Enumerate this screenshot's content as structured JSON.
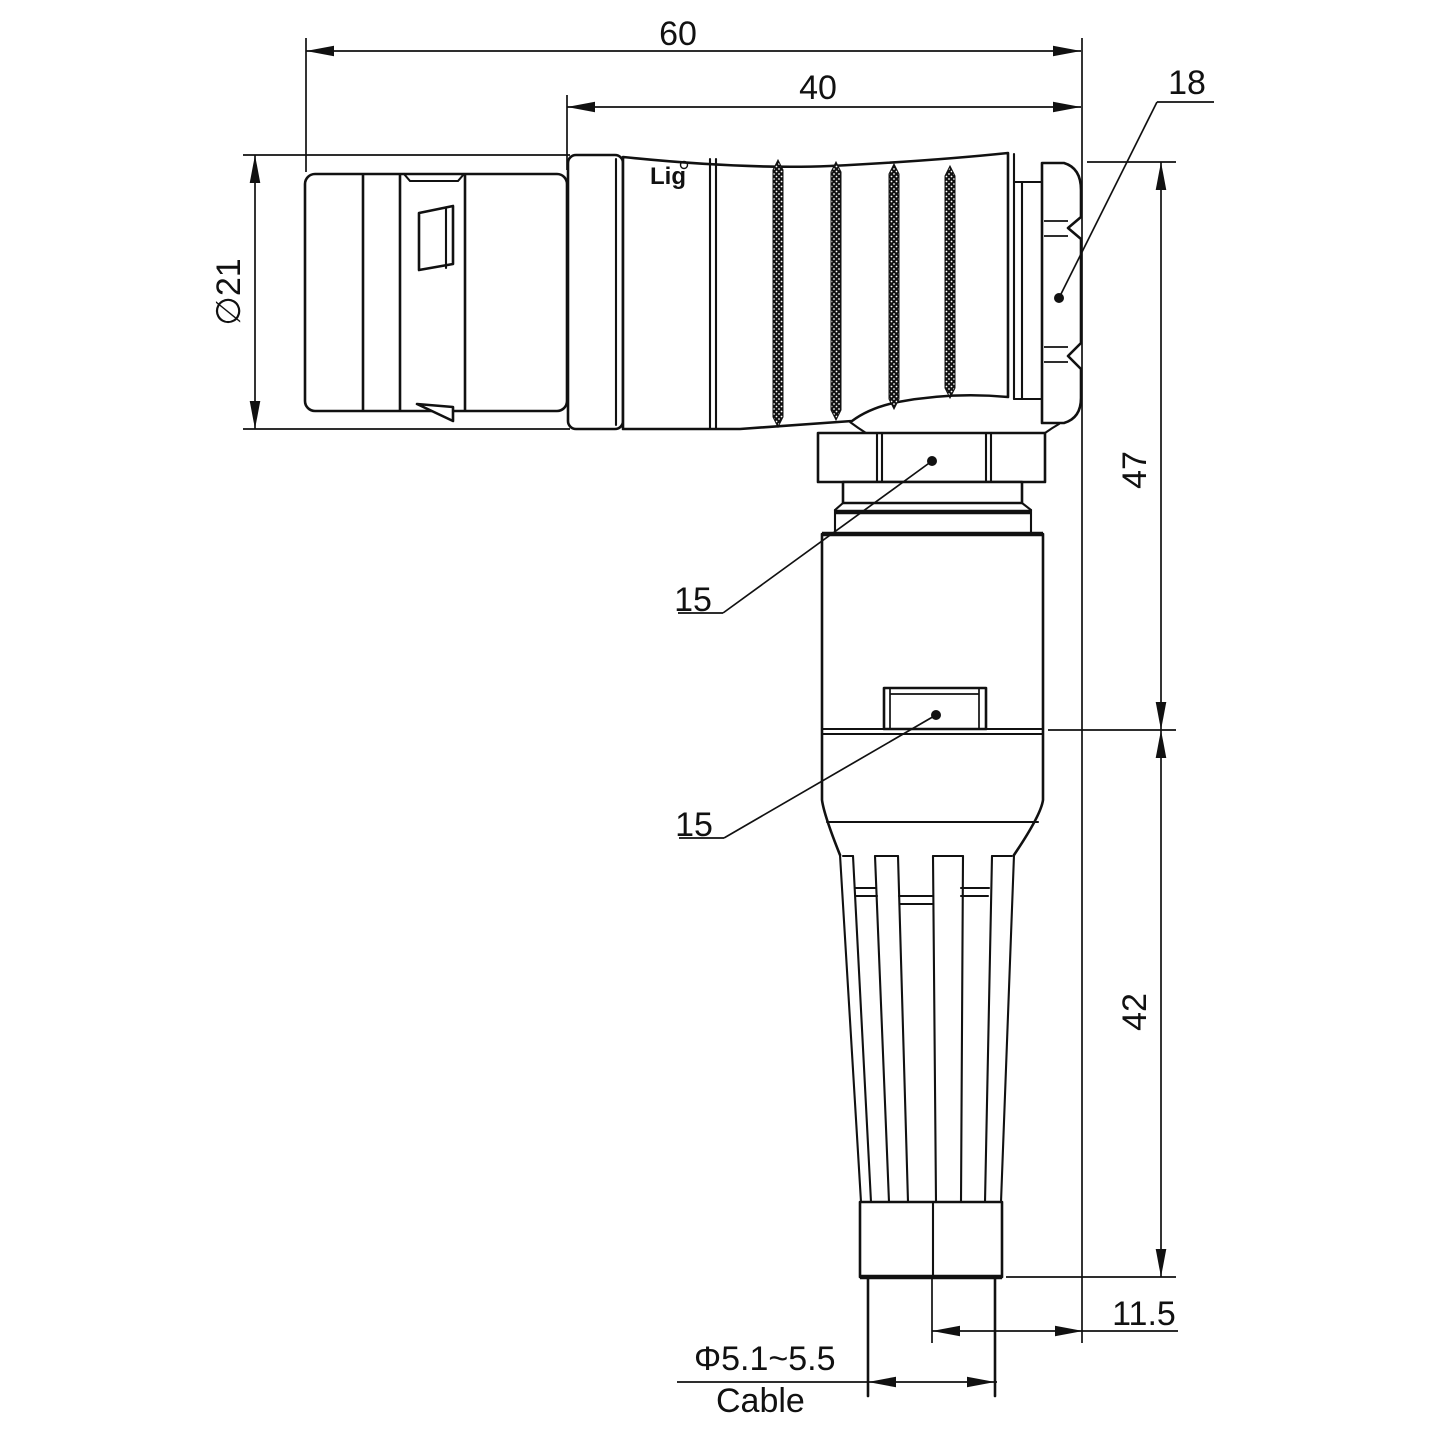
{
  "drawing": {
    "title_hint": "right-angle circular connector plug, dimensioned drawing",
    "watermark_text": "Lightany",
    "brand_mark": "Lig",
    "dims": {
      "overall_length": "60",
      "rear_length": "40",
      "shell_diameter": "∅21",
      "nut_across_flats": "18",
      "height_upper": "47",
      "height_lower": "42",
      "axis_to_face": "11.5",
      "coupling_nut_ref": "15",
      "body_ref": "15",
      "cable_diameter": "Φ5.1~5.5",
      "cable_label": "Cable"
    },
    "colors": {
      "line": "#111111",
      "watermark": "#f0b1b1",
      "background": "#ffffff"
    }
  }
}
